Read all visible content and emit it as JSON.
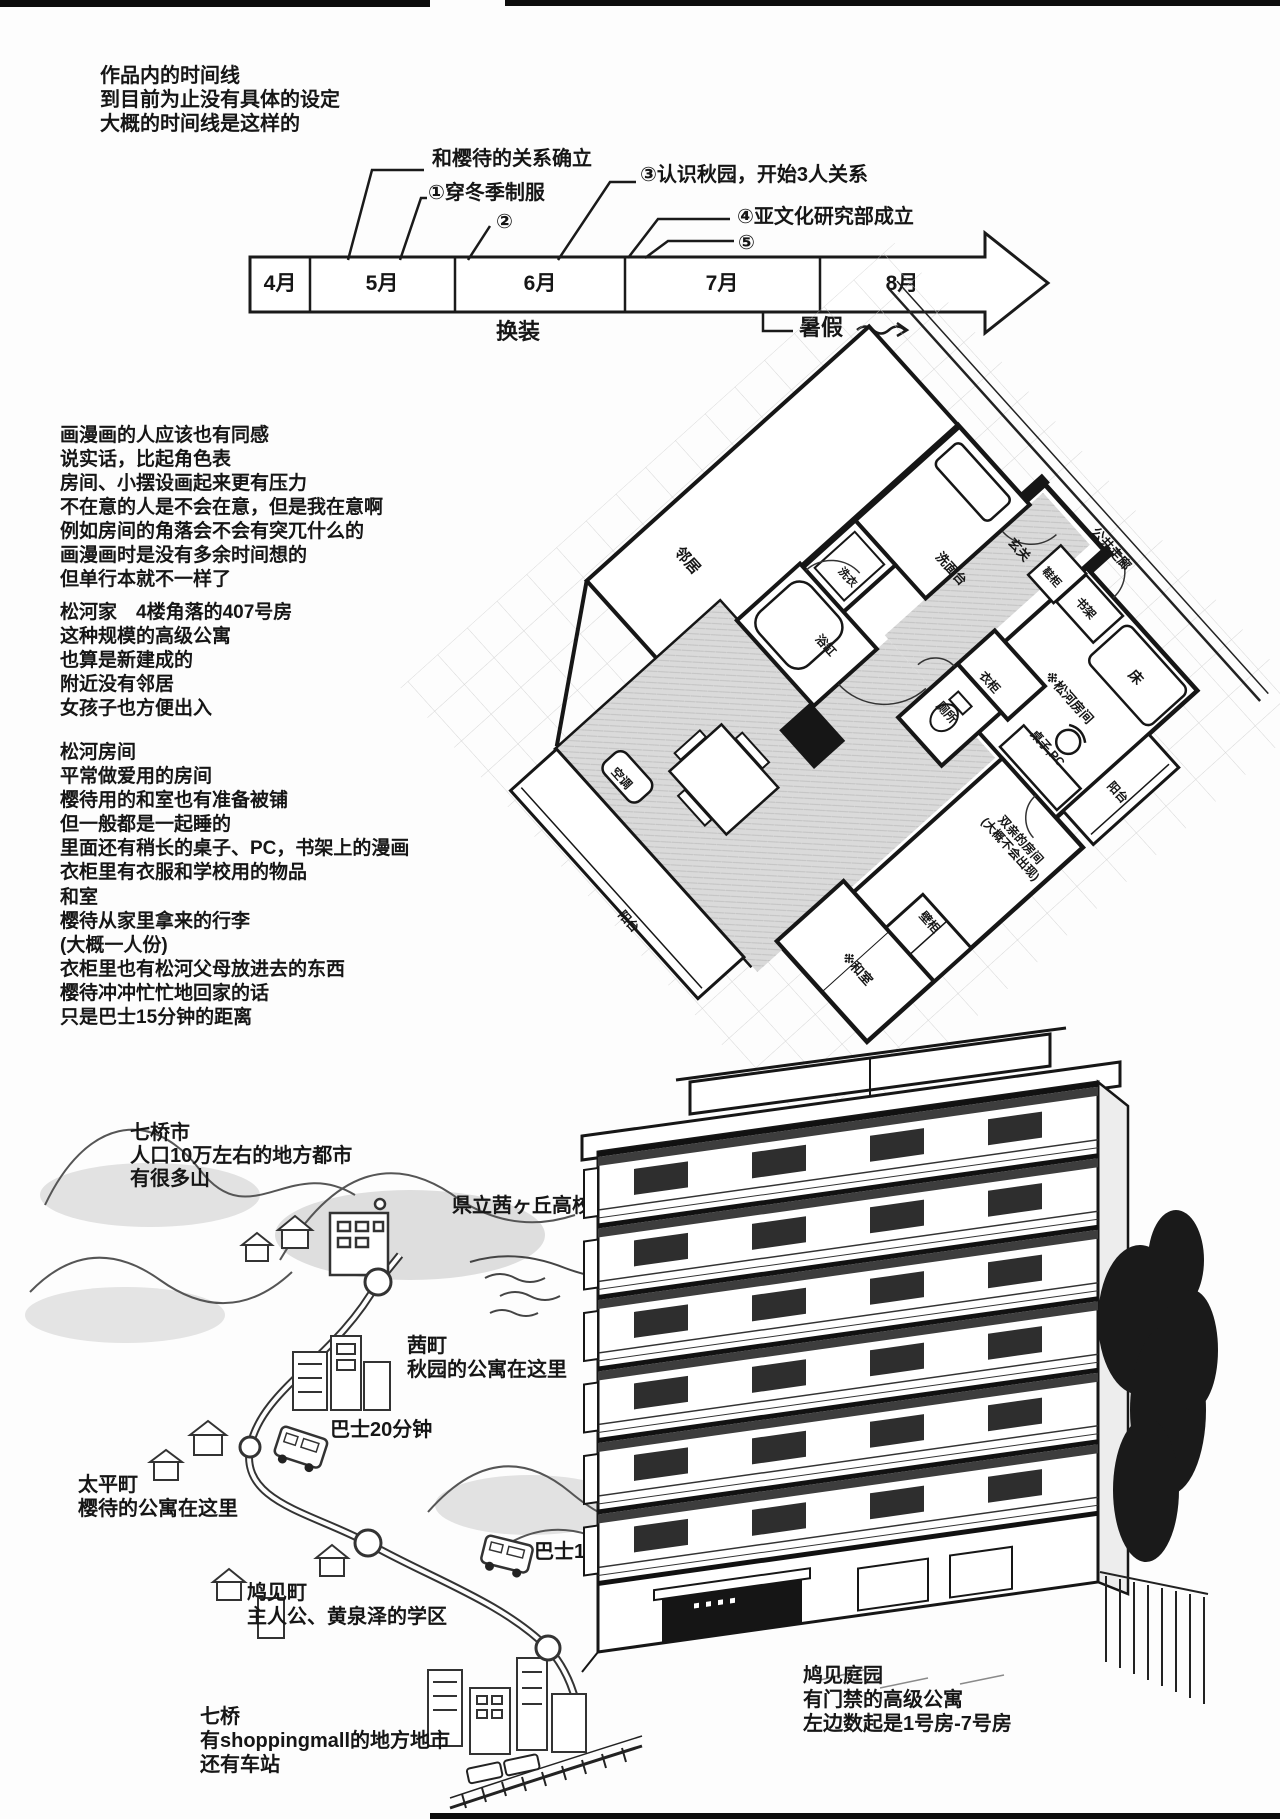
{
  "intro": [
    "作品内的时间线",
    "到目前为止没有具体的设定",
    "大概的时间线是这样的"
  ],
  "timeline": {
    "months": [
      "4月",
      "5月",
      "6月",
      "7月",
      "8月"
    ],
    "ann": {
      "a1": "和樱待的关系确立",
      "a2": "①穿冬季制服",
      "a3": "②",
      "a4": "③认识秋园，开始3人关系",
      "a5": "④亚文化研究部成立",
      "a6": "⑤"
    },
    "below": {
      "huanzhuang": "换装",
      "shujia": "暑假"
    }
  },
  "notes": {
    "manga": [
      "画漫画的人应该也有同感",
      "说实话，比起角色表",
      "房间、小摆设画起来更有压力",
      "不在意的人是不会在意，但是我在意啊",
      "例如房间的角落会不会有突兀什么的",
      "画漫画时是没有多余时间想的",
      "但单行本就不一样了"
    ],
    "house": [
      "松河家　4楼角落的407号房",
      "这种规模的高级公寓",
      "也算是新建成的",
      "附近没有邻居",
      "女孩子也方便出入"
    ],
    "room": [
      "松河房间",
      "平常做爱用的房间",
      "樱待用的和室也有准备被铺",
      "但一般都是一起睡的",
      "里面还有稍长的桌子、PC，书架上的漫画",
      "衣柜里有衣服和学校用的物品"
    ],
    "washitsu": [
      "和室",
      "樱待从家里拿来的行李",
      "(大概一人份)",
      "衣柜里也有松河父母放进去的东西",
      "樱待冲冲忙忙地回家的话",
      "只是巴士15分钟的距离"
    ]
  },
  "plan": {
    "neighbor": "邻居",
    "corridor": "公共走廊",
    "washstand": "洗面台",
    "entrance": "玄关",
    "shoe": "鞋柜",
    "bookshelf": "书架",
    "bed": "床",
    "matsukawa": "※松河房间",
    "washer": "洗衣",
    "bathtub": "浴缸",
    "toilet": "厕所",
    "closet": "衣柜",
    "desk": "桌子,PC",
    "balcony_r": "阳台",
    "parents1": "双亲的房间",
    "parents2": "(大概不会出现)",
    "closet2": "壁柜",
    "washitsu": "※和室",
    "ac": "空调",
    "balcony_l": "阳台"
  },
  "map": {
    "city": [
      "七桥市",
      "人口10万左右的地方都市",
      "有很多山"
    ],
    "school": "県立茜ヶ丘高校",
    "akane": [
      "茜町",
      "秋园的公寓在这里"
    ],
    "bus20": "巴士20分钟",
    "taihei": [
      "太平町",
      "樱待的公寓在这里"
    ],
    "bus15": "巴士15分钟",
    "hatomi": [
      "鸠见町",
      "主人公、黄泉泽的学区"
    ],
    "nanahashi": [
      "七桥",
      "有shoppingmall的地方地市",
      "还有车站"
    ]
  },
  "building": {
    "caption": [
      "鸠见庭园",
      "有门禁的高级公寓",
      "左边数起是1号房-7号房"
    ]
  }
}
